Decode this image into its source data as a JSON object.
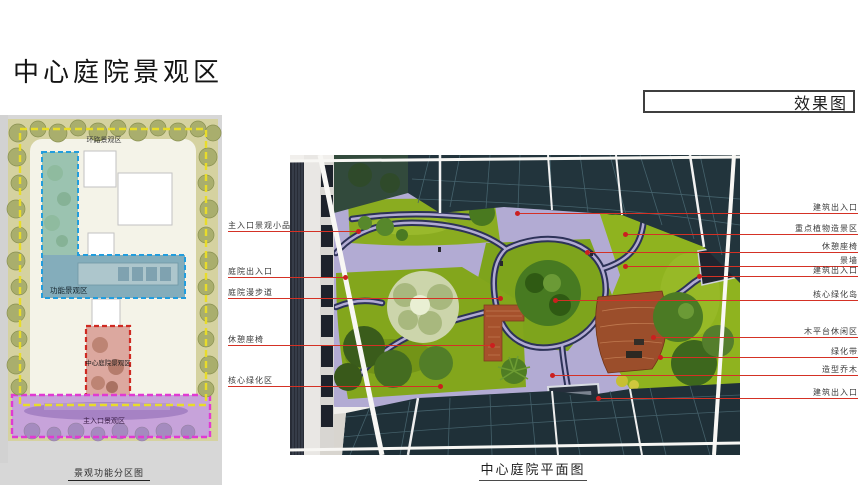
{
  "page": {
    "title": "中心庭院景观区",
    "corner_label": "效果图"
  },
  "site_plan": {
    "caption": "景观功能分区图",
    "zones": [
      {
        "label": "环路景观区",
        "dash_color": "#e8dc2a"
      },
      {
        "label": "功能景观区",
        "dash_color": "#229ddd"
      },
      {
        "label": "中心庭院景观区",
        "dash_color": "#cf2a22"
      },
      {
        "label": "主入口景观区",
        "dash_color": "#e03ad2"
      }
    ]
  },
  "rendering": {
    "caption": "中心庭院平面图",
    "colors": {
      "accent_red": "#d43125",
      "lawn_green": "#85a81e",
      "path_navy": "#2d3258",
      "paving_lavender": "#b2abd3",
      "canopy_teal": "#22343c",
      "brick_terrace": "#a6512c"
    },
    "annotations_left": [
      {
        "label": "主入口景观小品",
        "y": 231,
        "dot_x": 358
      },
      {
        "label": "庭院出入口",
        "y": 277,
        "dot_x": 345
      },
      {
        "label": "庭院漫步道",
        "y": 298,
        "dot_x": 500
      },
      {
        "label": "休憩座椅",
        "y": 345,
        "dot_x": 492
      },
      {
        "label": "核心绿化区",
        "y": 386,
        "dot_x": 440
      }
    ],
    "annotations_right": [
      {
        "label": "建筑出入口",
        "y": 213,
        "dot_x": 517
      },
      {
        "label": "重点植物造景区",
        "y": 234,
        "dot_x": 625
      },
      {
        "label": "休憩座椅",
        "y": 252,
        "dot_x": 587
      },
      {
        "label": "景墙",
        "y": 266,
        "dot_x": 625
      },
      {
        "label": "建筑出入口",
        "y": 276,
        "dot_x": 699
      },
      {
        "label": "核心绿化岛",
        "y": 300,
        "dot_x": 555
      },
      {
        "label": "木平台休闲区",
        "y": 337,
        "dot_x": 653
      },
      {
        "label": "绿化带",
        "y": 357,
        "dot_x": 660
      },
      {
        "label": "造型乔木",
        "y": 375,
        "dot_x": 552
      },
      {
        "label": "建筑出入口",
        "y": 398,
        "dot_x": 598
      }
    ]
  }
}
